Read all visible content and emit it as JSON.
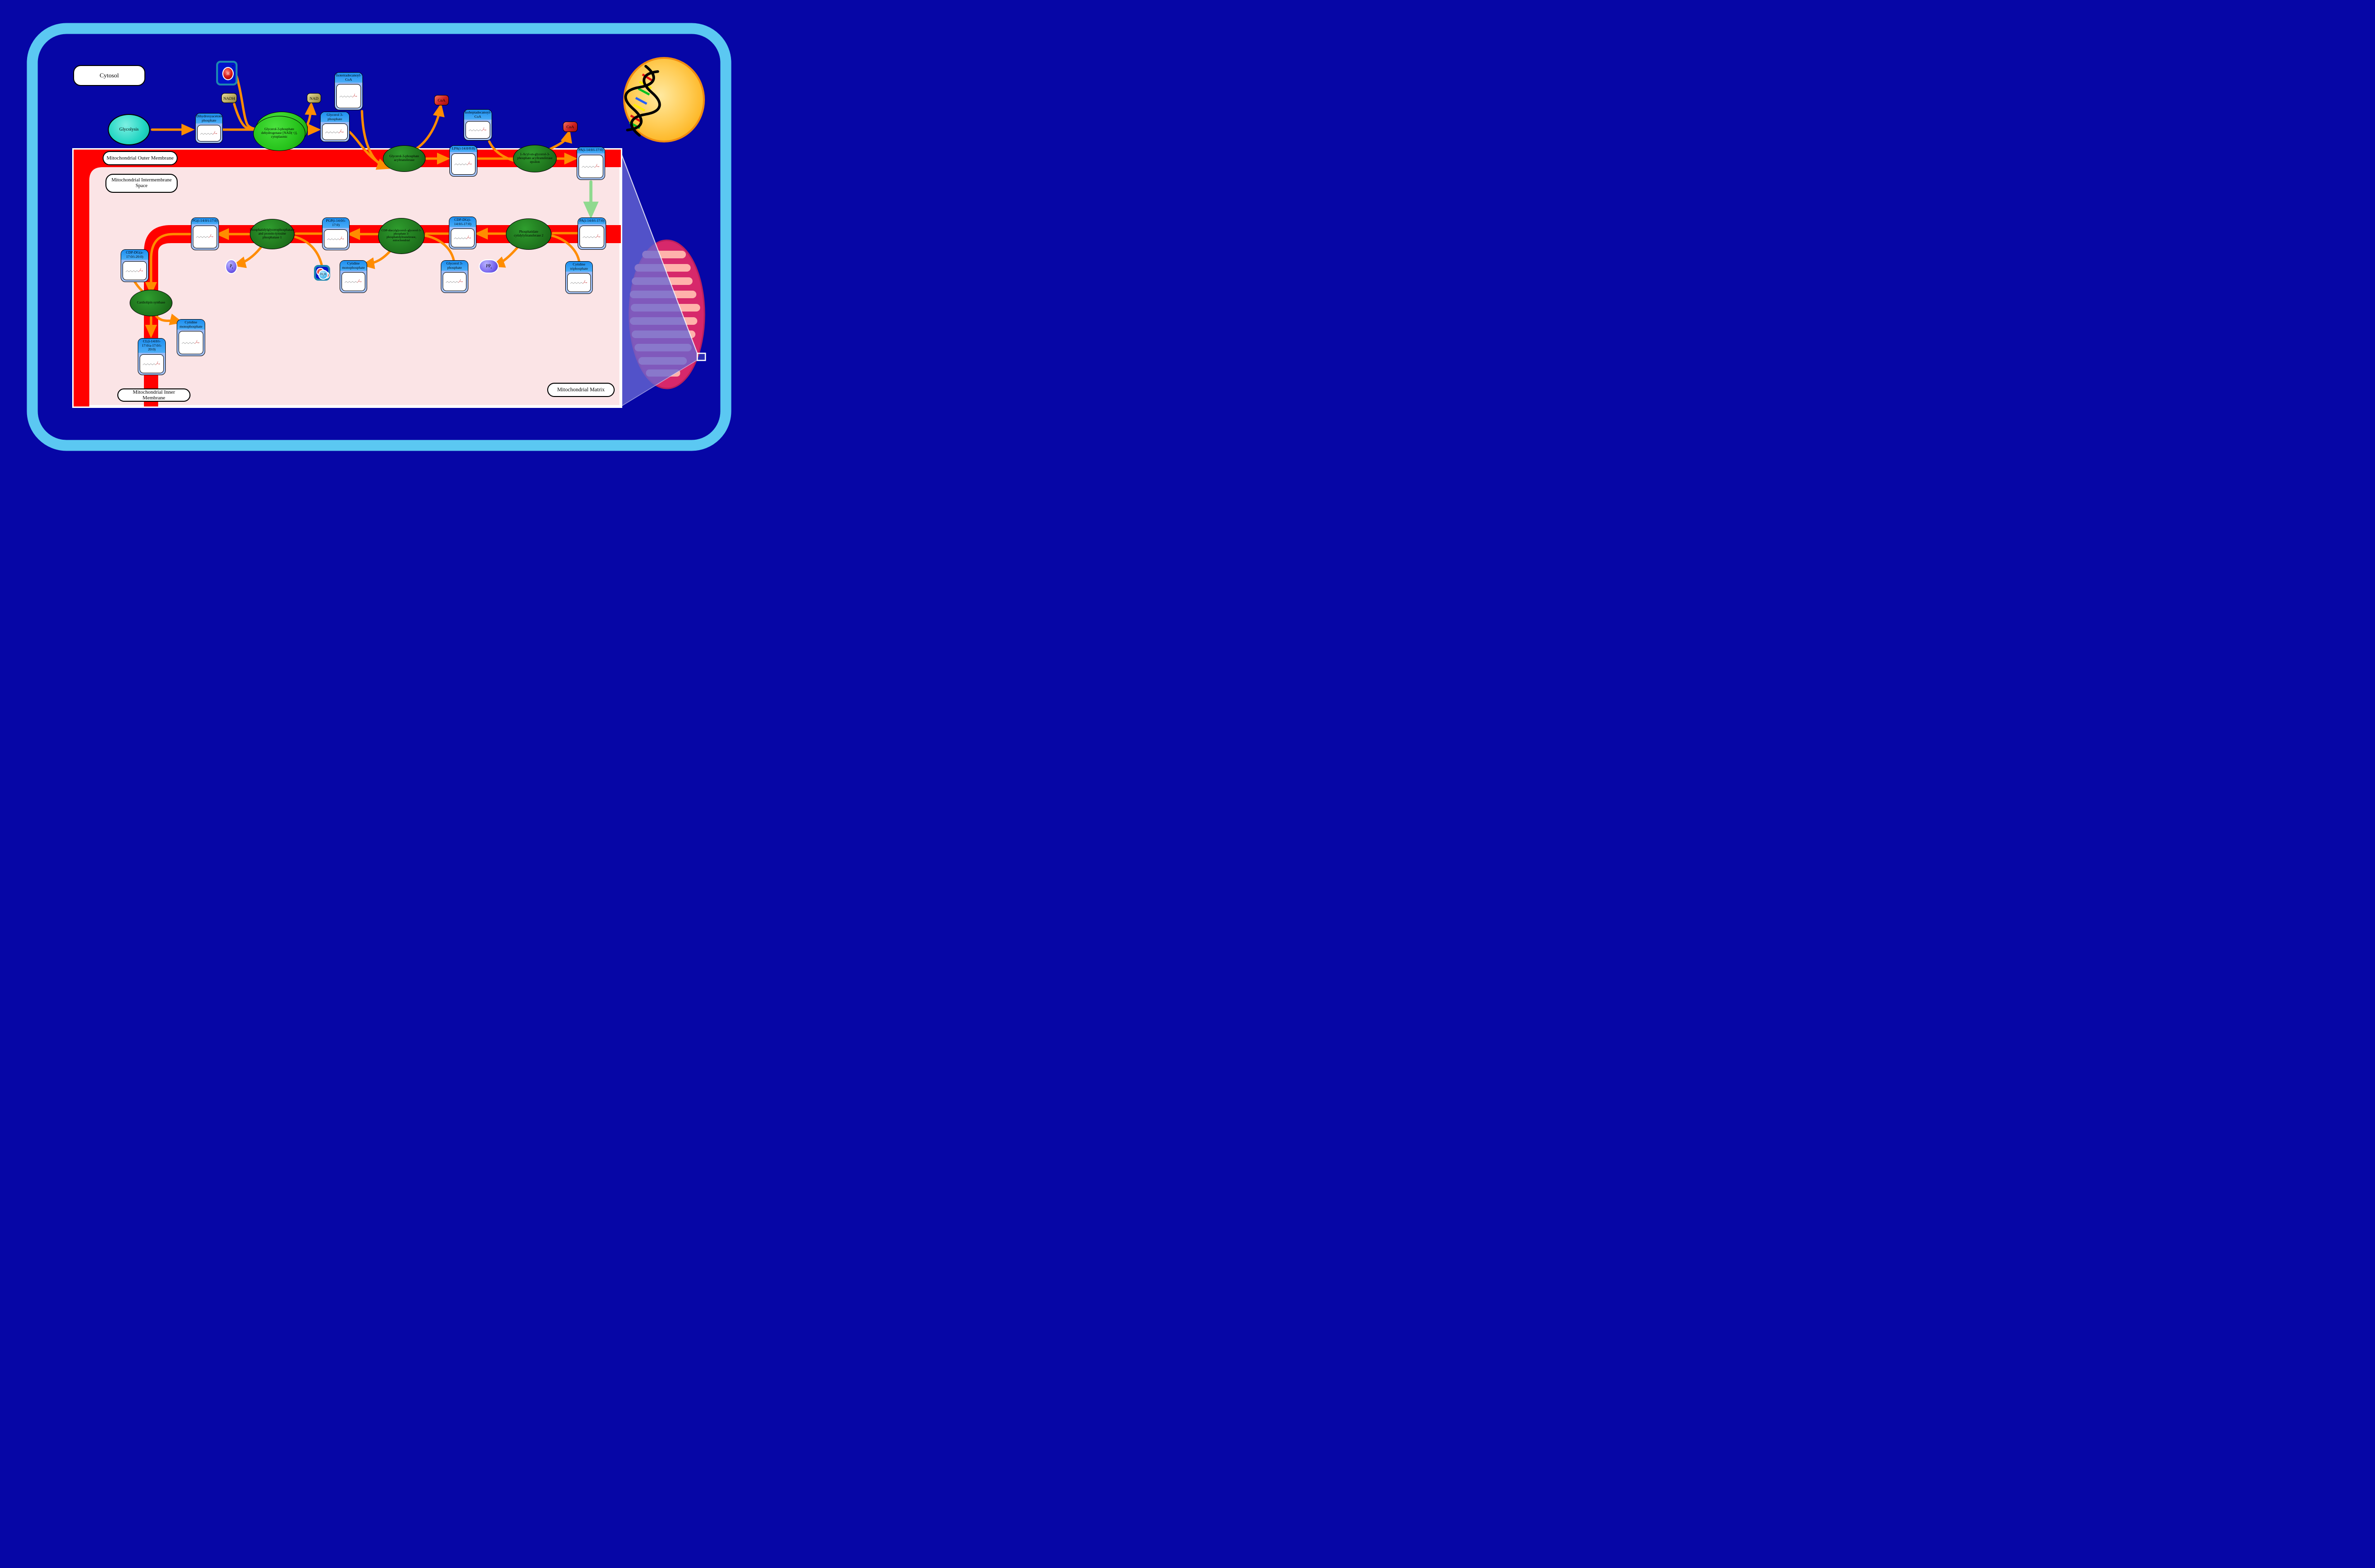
{
  "labels": {
    "cytosol": "Cytosol",
    "outer_membrane": "Mitochondrial Outer Membrane",
    "intermembrane_space": "Mitochondrial Intermembrane Space",
    "inner_membrane": "Mitochondrial Inner Membrane",
    "matrix": "Mitochondrial Matrix"
  },
  "process": {
    "glycolysis": "Glycolysis"
  },
  "metabolites": {
    "dhap": "Dihydroxyacetone phosphate",
    "g3p_cytosol": "Glycerol 3-phosphate",
    "iso14_coa": "Isotetradecanoyl-CoA",
    "iso17_coa": "Isoheptadecanoyl-CoA",
    "lpa": "LPA(i-14:0/0:0)",
    "pa_outer": "PA(i-14:0/i-17:0)",
    "pa_inner": "PA(i-14:0/i-17:0)",
    "cdp_dg": "CDP-DG(i-14:0/i-17:0)",
    "pgp": "PGP(i-14:0/i-17:0)",
    "pg": "PG(i-14:0/i-17:0)",
    "cdp_dg_a": "CDP-DG(a-17:0/i-20:0)",
    "cl": "CL(i-14:0/i-17:0/a-17:0/i-20:0)",
    "cmp_left": "Cytidine monophosphate",
    "cmp_mid": "Cytidine monophosphate",
    "g3p_matrix": "Glycerol 3-phosphate",
    "ctp": "Cytidine triphosphate"
  },
  "enzymes": {
    "gpd": "Glycerol-3-phosphate dehydrogenase [NAD(+)], cytoplasmic",
    "gpat": "Glycerol-3-phosphate acyltransferase",
    "agpat_e": "1-Acyl-sn-glycerol-3-phosphate acyltransferase epsilon",
    "cds2": "Phosphatidate cytidylyltransferase 2",
    "pgs1": "CDP-diacylglycerol--glycerol-3-phosphate 3-phosphatidyltransferase, mitochondrial",
    "ptpmt1": "Phosphatidylglycerophosphatase and protein-tyrosine phosphatase 1",
    "cls": "Cardiolipin synthase"
  },
  "cofactors": {
    "nadh": "NADH",
    "nad": "NAD",
    "coa": "CoA",
    "proton_symbol": "H",
    "proton_charge": "+",
    "water_h": "H",
    "water_sub": "2",
    "water_o": "O",
    "pi_symbol": "P",
    "pi_sub": "i",
    "ppi_symbol": "PP",
    "ppi_sub": "i"
  },
  "colors": {
    "background": "#0606A6",
    "cell_border": "#5BC8F2",
    "membrane": "#FF0000",
    "compartment_fill": "#FBE4E6",
    "reaction_arrow": "#FF8C00",
    "transport_arrow": "#8FD98F",
    "metabolite_header": "#1D8EF0",
    "metabolite_body": "#A9C6F8",
    "enzyme_green": "#1D6F1B",
    "enzyme_bright_green": "#27C31C",
    "glycolysis_teal": "#23D6C3",
    "nad_khaki": "#B7A95F",
    "coa_red": "#CF2121",
    "phosphate_purple": "#7D6CF0",
    "ion_box_blue": "#0013CC",
    "nucleus_yellow": "#FFB420",
    "mitochondrion_pink": "#D7286B",
    "cristae_pink": "#FFB2AB",
    "callout_purple": "#6868D4"
  }
}
